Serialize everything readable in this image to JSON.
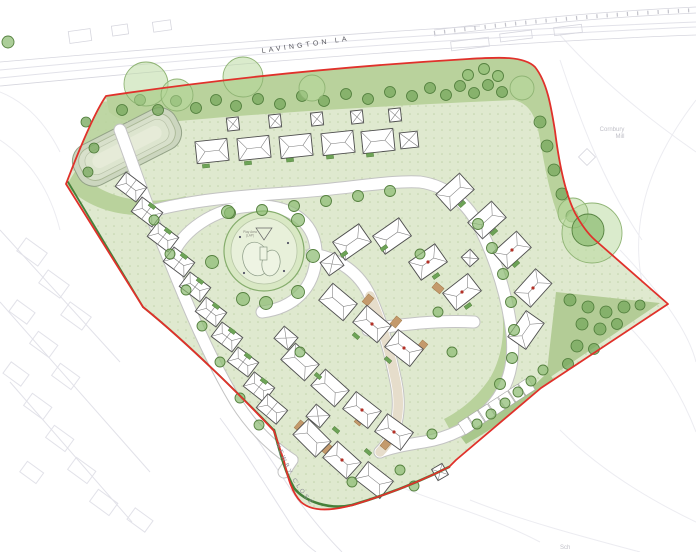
{
  "document": {
    "type": "residential-development-site-plan",
    "site_area_shape": "irregular polygon outlined in red"
  },
  "labels": {
    "lavington_lane": "LAVINGTON LANE",
    "newby_close": "NEWBY CLOSE",
    "cornbury_mill_line1": "Cornbury",
    "cornbury_mill_line2": "Mill",
    "sch": "Sch",
    "play_area_line1": "Play Area",
    "play_area_line2": "(LAP)"
  },
  "colors": {
    "site_boundary_red": "#e0312b",
    "development_green": "#dfe9cf",
    "tree_belt_green": "#b9d29c",
    "tree_green": "#8cbb72",
    "canopy_green": "#b5d79a",
    "hedgerow_green": "#45803a",
    "road_white": "#ffffff",
    "road_edge_grey": "#c3c3c3",
    "house_outline_grey": "#4d4d4d",
    "parking_tan": "#c49a6c",
    "pond_grey_green": "#ccd6bf",
    "shared_surface_beige": "#e6ddcb",
    "basemap_grey": "#e2e2e9",
    "ridge_marker_red": "#b23127"
  },
  "map_features": [
    "site-boundary",
    "attenuation-basin",
    "play-area",
    "tree-belt",
    "hedgerow",
    "housing-plots",
    "garages",
    "parking-bays",
    "street-trees",
    "shared-surface-street",
    "existing-roads-basemap"
  ]
}
